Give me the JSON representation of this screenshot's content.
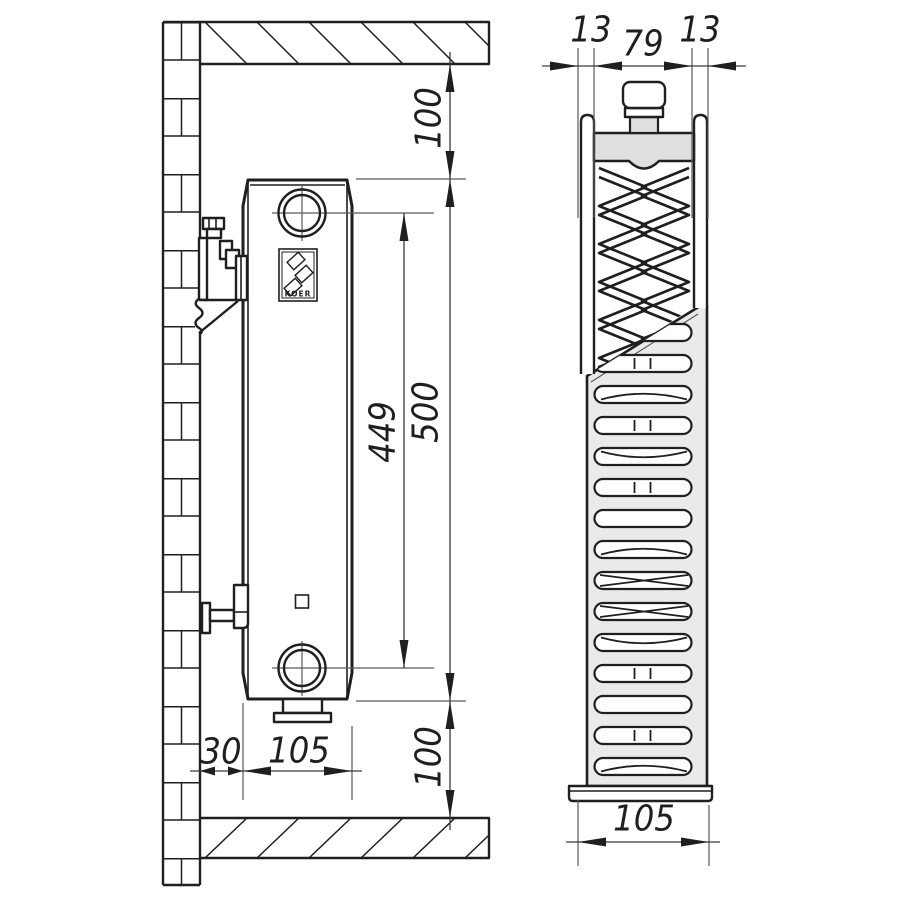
{
  "colors": {
    "line": "#1f1f1f",
    "thin": "#5a5a5a",
    "dim": "#3a3a3a",
    "panel_gray": "#dfdfdf",
    "grille_gray": "#eaeaea",
    "background": "#ffffff"
  },
  "logo": {
    "brand": "KOER"
  },
  "side_view_dims": {
    "ceiling_clearance": "100",
    "radiator_height": "500",
    "connection_spacing": "449",
    "wall_gap": "30",
    "depth": "105",
    "floor_clearance": "100"
  },
  "front_view_dims": {
    "left_panel": "13",
    "center_width": "79",
    "right_panel": "13",
    "depth": "105"
  }
}
